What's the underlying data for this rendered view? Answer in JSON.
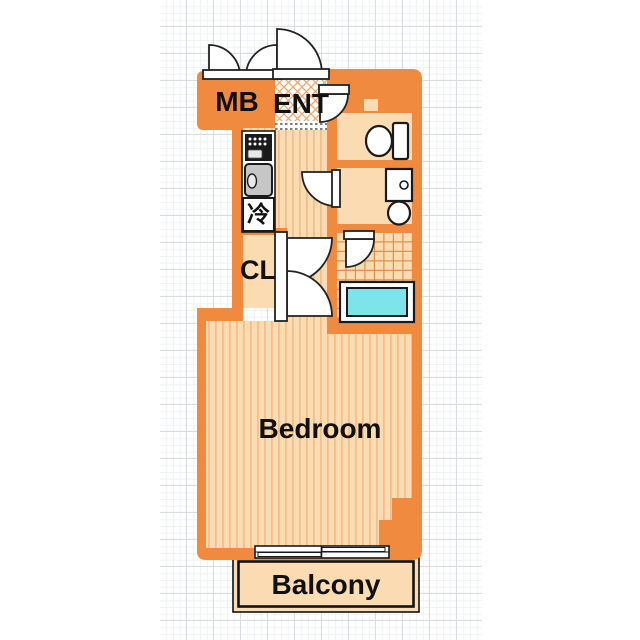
{
  "floor_plan": {
    "labels": {
      "meter_box": "MB",
      "entrance": "ENT",
      "refrigerator": "冷",
      "closet": "CL",
      "bedroom": "Bedroom",
      "balcony": "Balcony"
    },
    "colors": {
      "wall": "#EF8A3E",
      "floor": "#FBDCB2",
      "floor_stripe": "#F2BE8C",
      "tile_line": "#E0904E",
      "hatch_line": "#ECA96F",
      "bathtub_water": "#7EE4EC",
      "sink": "#C6C6C6",
      "fixture_outline": "#1A1A1A",
      "grid_major": "#D9DDE1",
      "grid_minor": "#F0F2F4"
    }
  }
}
